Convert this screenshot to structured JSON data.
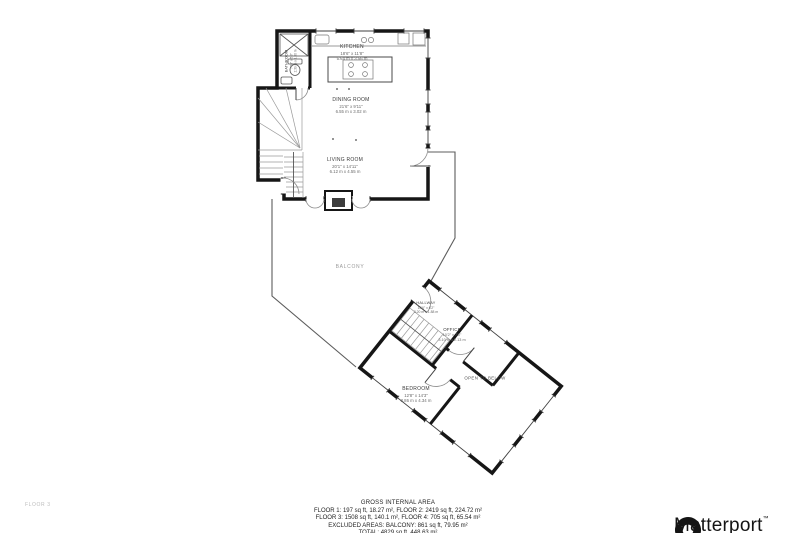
{
  "floor_label": "FLOOR 3",
  "brand": {
    "name": "Matterport",
    "mark": "™"
  },
  "labels": {
    "balcony": "BALCONY",
    "open_to_below": "OPEN TO BELOW"
  },
  "rooms": {
    "kitchen": {
      "name": "KITCHEN",
      "imperial": "18'6\" x 11'8\"",
      "metric": "5.64 m x 3.56 m"
    },
    "dining": {
      "name": "DINING ROOM",
      "imperial": "21'6\" x 9'11\"",
      "metric": "6.55 m x 3.02 m"
    },
    "living": {
      "name": "LIVING ROOM",
      "imperial": "20'1\" x 14'11\"",
      "metric": "6.12 m x 4.55 m"
    },
    "bathroom": {
      "name": "BATHROOM",
      "imperial": "7'10\" x 5'3\"",
      "metric": "2.39 m x 1.60 m"
    },
    "hallway": {
      "name": "HALLWAY",
      "imperial": "10'6\" x 6'2\"",
      "metric": "3.20 m x 1.88 m"
    },
    "office": {
      "name": "OFFICE",
      "imperial": "10'2\" x 7'0\"",
      "metric": "3.10 m x 2.13 m"
    },
    "bedroom": {
      "name": "BEDROOM",
      "imperial": "12'8\" x 14'3\"",
      "metric": "3.86 m x 4.34 m"
    }
  },
  "footer": {
    "title": "GROSS INTERNAL AREA",
    "line1": "FLOOR 1: 197 sq ft, 18.27 m², FLOOR 2: 2419 sq ft, 224.72 m²",
    "line2": "FLOOR 3: 1508 sq ft, 140.1 m², FLOOR 4: 705 sq ft, 65.54 m²",
    "line3": "EXCLUDED AREAS: BALCONY: 861 sq ft, 79.95 m²",
    "line4": "TOTAL: 4829 sq ft, 448.63 m²"
  }
}
